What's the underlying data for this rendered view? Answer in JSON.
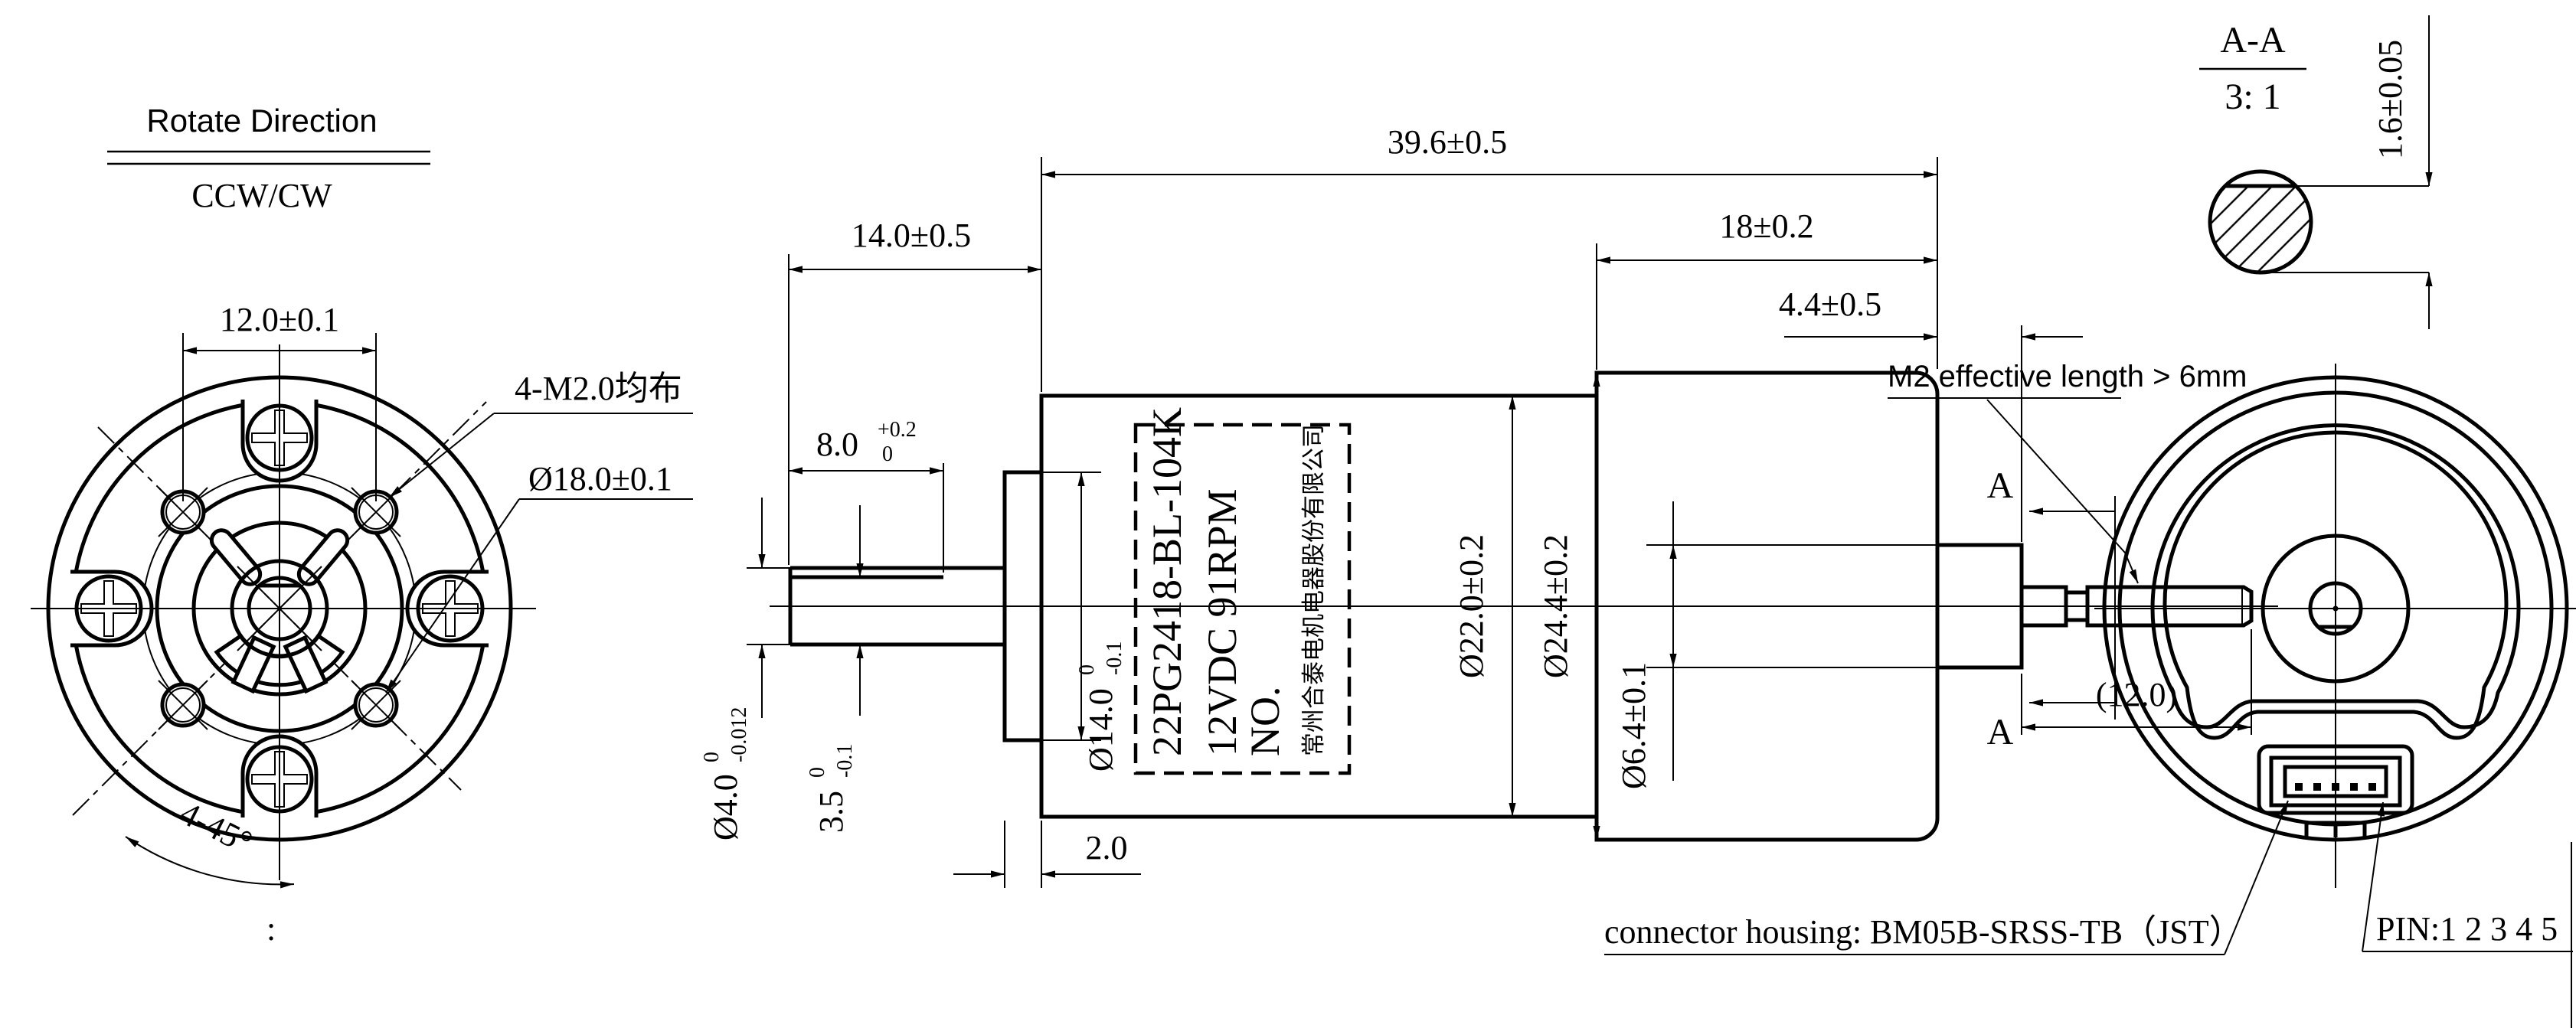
{
  "colors": {
    "ink": "#000000",
    "paper": "#ffffff"
  },
  "labels": {
    "rotate_direction_title": "Rotate Direction",
    "rotate_direction_value": "CCW/CW",
    "colon_mark": ":"
  },
  "front_view": {
    "dim_hole_spacing": "12.0±0.1",
    "screw_note": "4-M2.0均布",
    "dim_bolt_circle": "Ø18.0±0.1",
    "dim_chamfer_angle": "4-45°"
  },
  "side_view": {
    "dim_total_length": "39.6±0.5",
    "dim_gearbox_length": "14.0±0.5",
    "dim_motor_length": "18±0.2",
    "dim_rear_boss_length": "4.4±0.5",
    "dim_flat_length": "8.0",
    "dim_flat_length_tol_upper": "+0.2",
    "dim_flat_length_tol_lower": "0",
    "dim_shaft_dia": "Ø4.0",
    "dim_shaft_dia_tol_upper": "0",
    "dim_shaft_dia_tol_lower": "-0.012",
    "dim_flat_height": "3.5",
    "dim_flat_height_tol_upper": "0",
    "dim_flat_height_tol_lower": "-0.1",
    "dim_pilot_dia": "Ø14.0",
    "dim_pilot_dia_tol_upper": "0",
    "dim_pilot_dia_tol_lower": "-0.1",
    "dim_gearbox_dia": "Ø22.0±0.2",
    "dim_motor_dia": "Ø24.4±0.2",
    "dim_rear_boss_dia": "Ø6.4±0.1",
    "dim_rear_shaft_length": "(12.0)",
    "dim_flange_width": "2.0",
    "section_mark": "A",
    "m2_note": "M2 effective length > 6mm"
  },
  "motor_label": {
    "line1": "22PG2418-BL-104K",
    "line2": "12VDC 91RPM",
    "line3": "NO.",
    "line4": "常州合泰电机电器股份有限公司"
  },
  "section_view": {
    "title": "A-A",
    "scale": "3: 1",
    "dim_flat": "1.6±0.05"
  },
  "rear_view": {
    "connector_note": "connector housing: BM05B-SRSS-TB（JST）",
    "pin_note": "PIN:1 2 3 4 5"
  }
}
